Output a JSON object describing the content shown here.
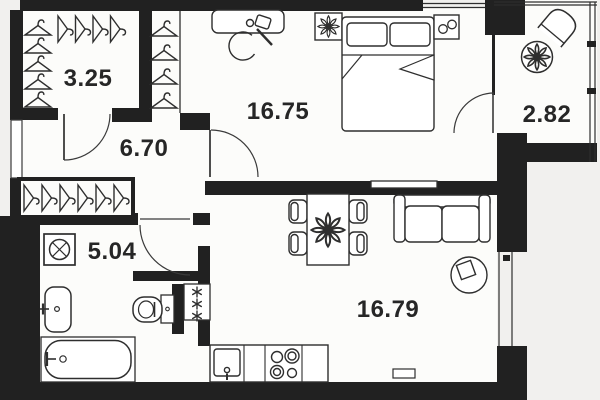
{
  "floorplan": {
    "title": "apartment-floor-plan",
    "colors": {
      "outside": "#f1f0ee",
      "floor": "#fcfcfa",
      "wall": "#212121",
      "furniture_line": "#2e2e2e",
      "label_text": "#262626"
    },
    "rooms": [
      {
        "name": "wardrobe",
        "area": "3.25"
      },
      {
        "name": "hallway",
        "area": "6.70"
      },
      {
        "name": "bedroom",
        "area": "16.75"
      },
      {
        "name": "balcony",
        "area": "2.82"
      },
      {
        "name": "bathroom",
        "area": "5.04"
      },
      {
        "name": "living-kitchen",
        "area": "16.79"
      }
    ]
  }
}
